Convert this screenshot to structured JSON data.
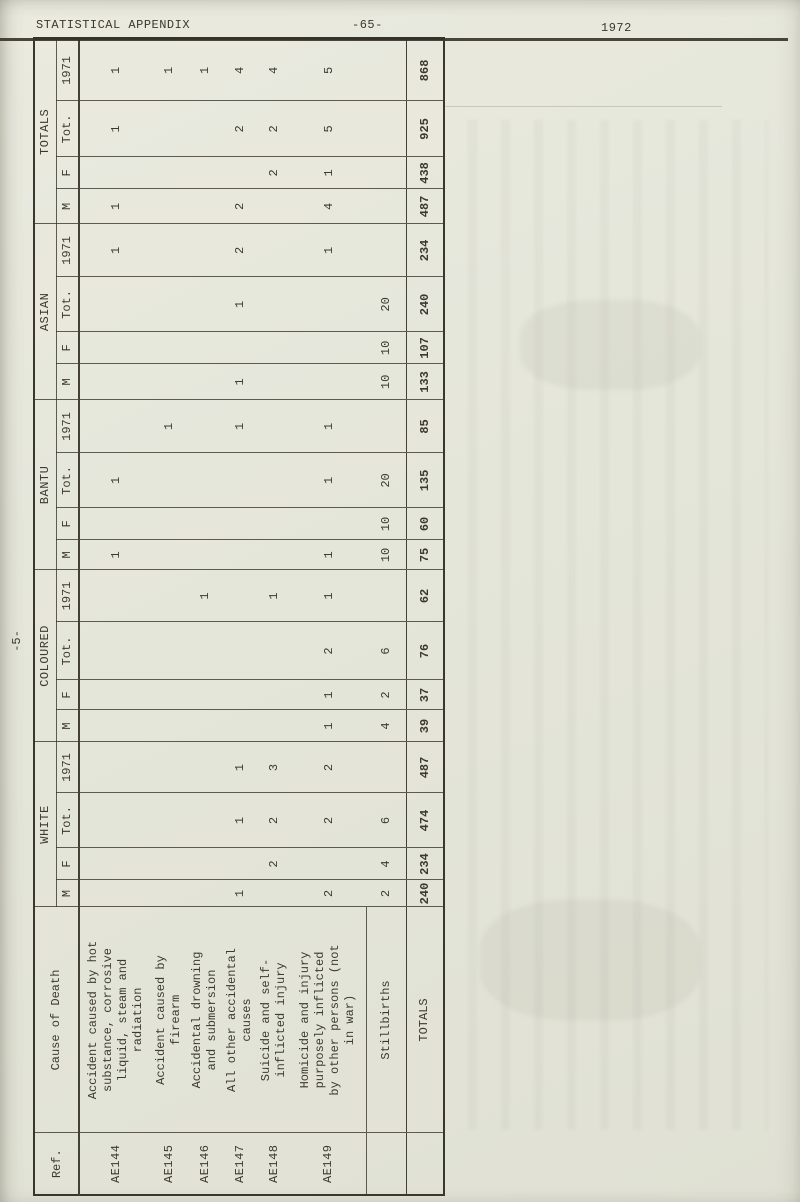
{
  "page": {
    "header_left": "STATISTICAL APPENDIX",
    "header_center": "-65-",
    "header_right": "1972",
    "margin_label": "-5-"
  },
  "table": {
    "headers": {
      "ref": "Ref.",
      "cause": "Cause of Death"
    },
    "groups": [
      "WHITE",
      "COLOURED",
      "BANTU",
      "ASIAN",
      "TOTALS"
    ],
    "sub_columns": [
      "M",
      "F",
      "Tot.",
      "1971"
    ],
    "rows": [
      {
        "ref": "AE144",
        "cause_lines": [
          "Accident caused by hot",
          "substance, corrosive",
          "liquid, steam and",
          "radiation"
        ],
        "values": {
          "white": [
            "",
            "",
            "",
            ""
          ],
          "coloured": [
            "",
            "",
            "",
            ""
          ],
          "bantu": [
            "1",
            "",
            "1",
            ""
          ],
          "asian": [
            "",
            "",
            "",
            "1"
          ],
          "totals": [
            "1",
            "",
            "1",
            "1"
          ]
        }
      },
      {
        "ref": "AE145",
        "cause_lines": [
          "Accident caused by",
          "firearm"
        ],
        "values": {
          "white": [
            "",
            "",
            "",
            ""
          ],
          "coloured": [
            "",
            "",
            "",
            ""
          ],
          "bantu": [
            "",
            "",
            "",
            "1"
          ],
          "asian": [
            "",
            "",
            "",
            ""
          ],
          "totals": [
            "",
            "",
            "",
            "1"
          ]
        }
      },
      {
        "ref": "AE146",
        "cause_lines": [
          "Accidental drowning",
          "and submersion"
        ],
        "values": {
          "white": [
            "",
            "",
            "",
            ""
          ],
          "coloured": [
            "",
            "",
            "",
            "1"
          ],
          "bantu": [
            "",
            "",
            "",
            ""
          ],
          "asian": [
            "",
            "",
            "",
            ""
          ],
          "totals": [
            "",
            "",
            "",
            "1"
          ]
        }
      },
      {
        "ref": "AE147",
        "cause_lines": [
          "All other accidental",
          "causes"
        ],
        "values": {
          "white": [
            "1",
            "",
            "1",
            "1"
          ],
          "coloured": [
            "",
            "",
            "",
            ""
          ],
          "bantu": [
            "",
            "",
            "",
            "1"
          ],
          "asian": [
            "1",
            "",
            "1",
            "2"
          ],
          "totals": [
            "2",
            "",
            "2",
            "4"
          ]
        }
      },
      {
        "ref": "AE148",
        "cause_lines": [
          "Suicide and self-",
          "inflicted injury"
        ],
        "values": {
          "white": [
            "",
            "2",
            "2",
            "3"
          ],
          "coloured": [
            "",
            "",
            "",
            "1"
          ],
          "bantu": [
            "",
            "",
            "",
            ""
          ],
          "asian": [
            "",
            "",
            "",
            ""
          ],
          "totals": [
            "",
            "2",
            "2",
            "4"
          ]
        }
      },
      {
        "ref": "AE149",
        "cause_lines": [
          "Homicide and injury",
          "purposely inflicted",
          "by other persons (not",
          "in war)"
        ],
        "values": {
          "white": [
            "2",
            "",
            "2",
            "2"
          ],
          "coloured": [
            "1",
            "1",
            "2",
            "1"
          ],
          "bantu": [
            "1",
            "",
            "1",
            "1"
          ],
          "asian": [
            "",
            "",
            "",
            "1"
          ],
          "totals": [
            "4",
            "1",
            "5",
            "5"
          ]
        }
      },
      {
        "ref": "",
        "cause_lines": [
          "Stillbirths"
        ],
        "section_rule": true,
        "values": {
          "white": [
            "2",
            "4",
            "6",
            ""
          ],
          "coloured": [
            "4",
            "2",
            "6",
            ""
          ],
          "bantu": [
            "10",
            "10",
            "20",
            ""
          ],
          "asian": [
            "10",
            "10",
            "20",
            ""
          ],
          "totals": [
            "",
            "",
            "",
            ""
          ]
        }
      },
      {
        "ref": "",
        "cause_lines": [
          "TOTALS"
        ],
        "is_totals": true,
        "values": {
          "white": [
            "240",
            "234",
            "474",
            "487"
          ],
          "coloured": [
            "39",
            "37",
            "76",
            "62"
          ],
          "bantu": [
            "75",
            "60",
            "135",
            "85"
          ],
          "asian": [
            "133",
            "107",
            "240",
            "234"
          ],
          "totals": [
            "487",
            "438",
            "925",
            "868"
          ]
        }
      }
    ]
  }
}
